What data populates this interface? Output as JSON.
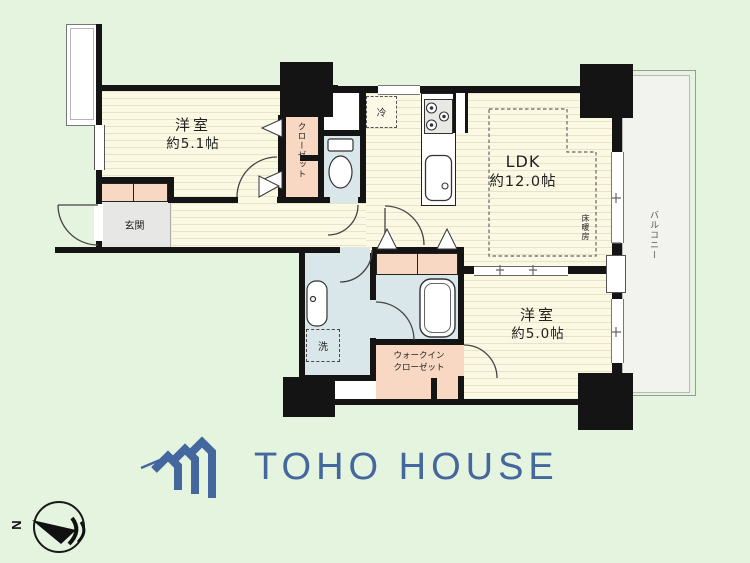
{
  "plan": {
    "rooms": [
      {
        "name": "洋室",
        "size": "約5.1帖"
      },
      {
        "name": "LDK",
        "size": "約12.0帖"
      },
      {
        "name": "洋室",
        "size": "約5.0帖"
      }
    ],
    "labels": {
      "genkan": "玄関",
      "closet": "クローゼット",
      "walk_in_closet": "ウォークイン\nクローゼット",
      "balcony": "バルコニー",
      "floor_heating": "床暖房",
      "washer": "洗",
      "fridge": "冷"
    },
    "compass": {
      "north_label": "N"
    }
  },
  "branding": {
    "logo_text": "TOHO HOUSE"
  },
  "colors": {
    "background": "#e4f4df",
    "floor": "#fbf8e4",
    "floor_stripe": "#e7e3c6",
    "wall": "#141414",
    "closet_pink": "#f8d8c3",
    "wet_area_blue": "#d9e7ea",
    "genkan_gray": "#e7e7e5",
    "balcony_gray": "#f2f2ef",
    "logo_blue": "#44679e"
  }
}
